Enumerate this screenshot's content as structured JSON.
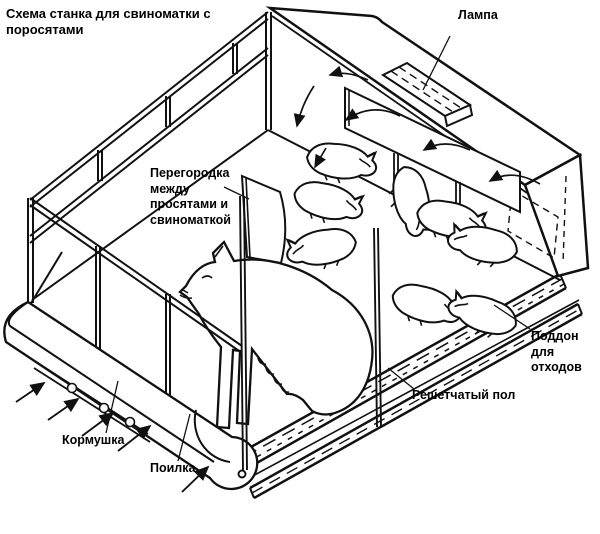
{
  "title": "Схема станка для свиноматки с поросятами",
  "labels": {
    "lamp": "Лампа",
    "partition": "Перегородка\nмежду\nпросятами и\nсвиноматкой",
    "waste_tray": "Поддон для\nотходов",
    "slatted_floor": "Решетчатый пол",
    "feeder": "Кормушка",
    "drinker": "Поилка"
  },
  "colors": {
    "line": "#111111",
    "background": "#ffffff"
  },
  "figures": {
    "sow_count": 1,
    "piglet_count": 8
  }
}
